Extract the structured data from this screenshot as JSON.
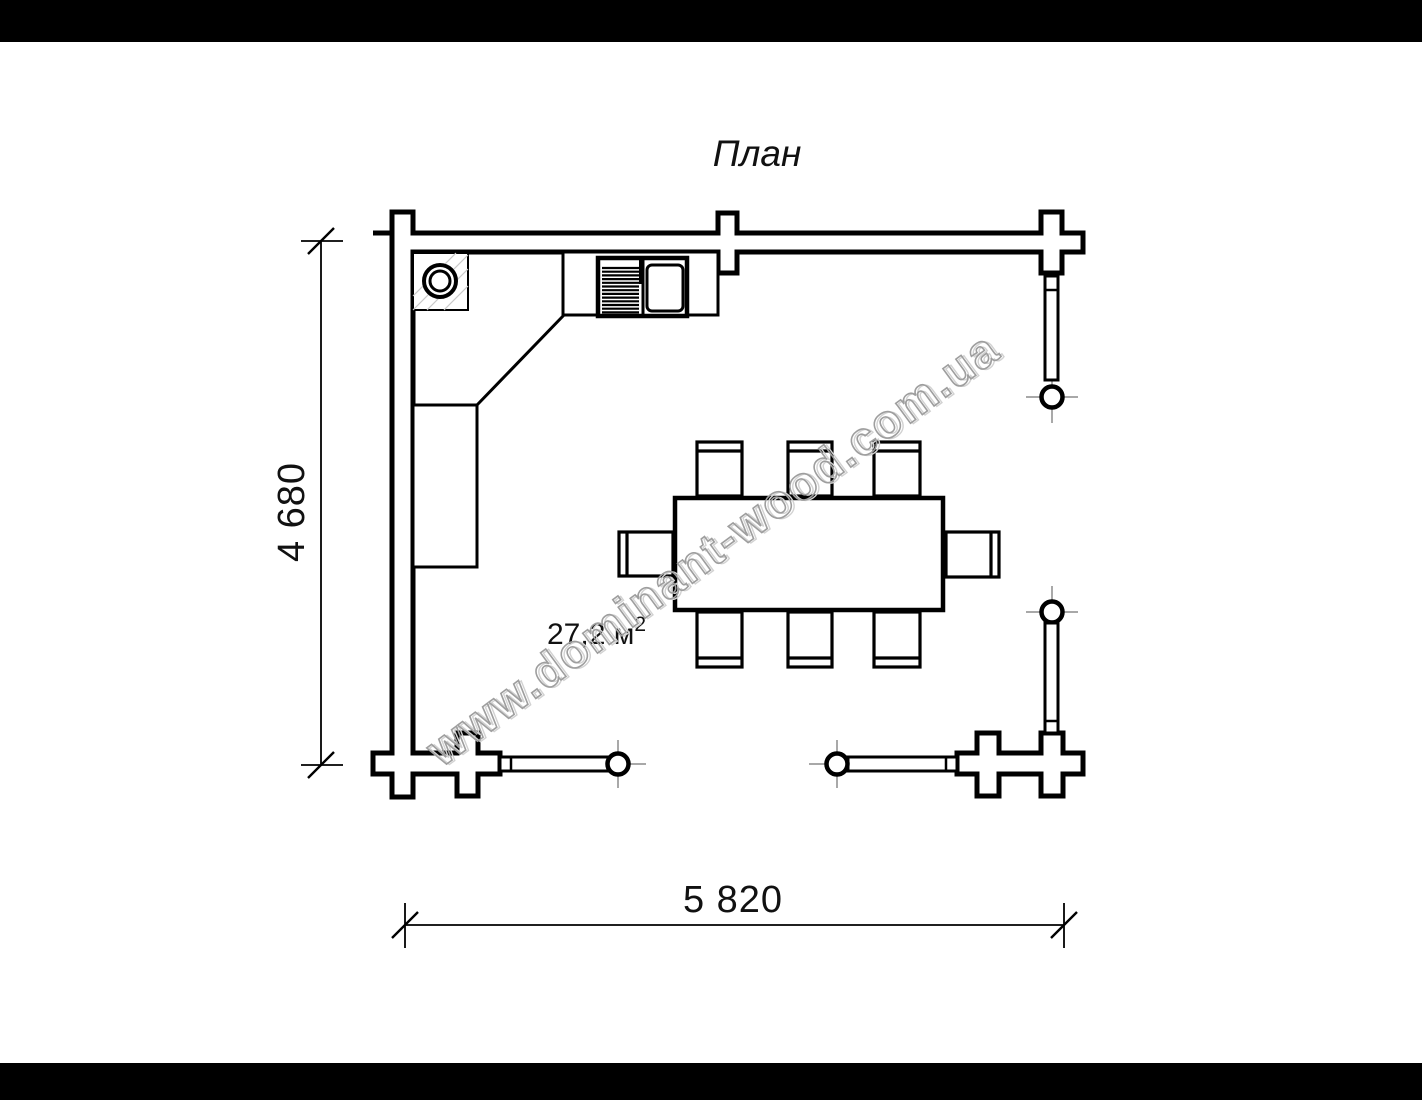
{
  "page": {
    "background": "#ffffff",
    "letterbox_color": "#000000",
    "line_color": "#000000",
    "watermark_color": "#9e9e9e",
    "tick_color": "#8c8c8c",
    "hatch_color": "#c8c8c8"
  },
  "title": "План",
  "watermark": {
    "text": "www.dominant-wood.com.ua"
  },
  "dimensions": {
    "height_label": "4 680",
    "width_label": "5 820"
  },
  "area": {
    "value_unit": "27,2 м",
    "sup": "2"
  },
  "plan_elements": {
    "walls": "log-wall-with-corner-posts",
    "railing_posts": 4,
    "railing_sections": 4,
    "boiler_icon": "round-stove-in-hatched-square",
    "kitchen_unit_icon": "cooktop-and-sink-counter",
    "bench_icon": "corner-bench",
    "table_icon": "dining-table",
    "chairs": 8
  }
}
